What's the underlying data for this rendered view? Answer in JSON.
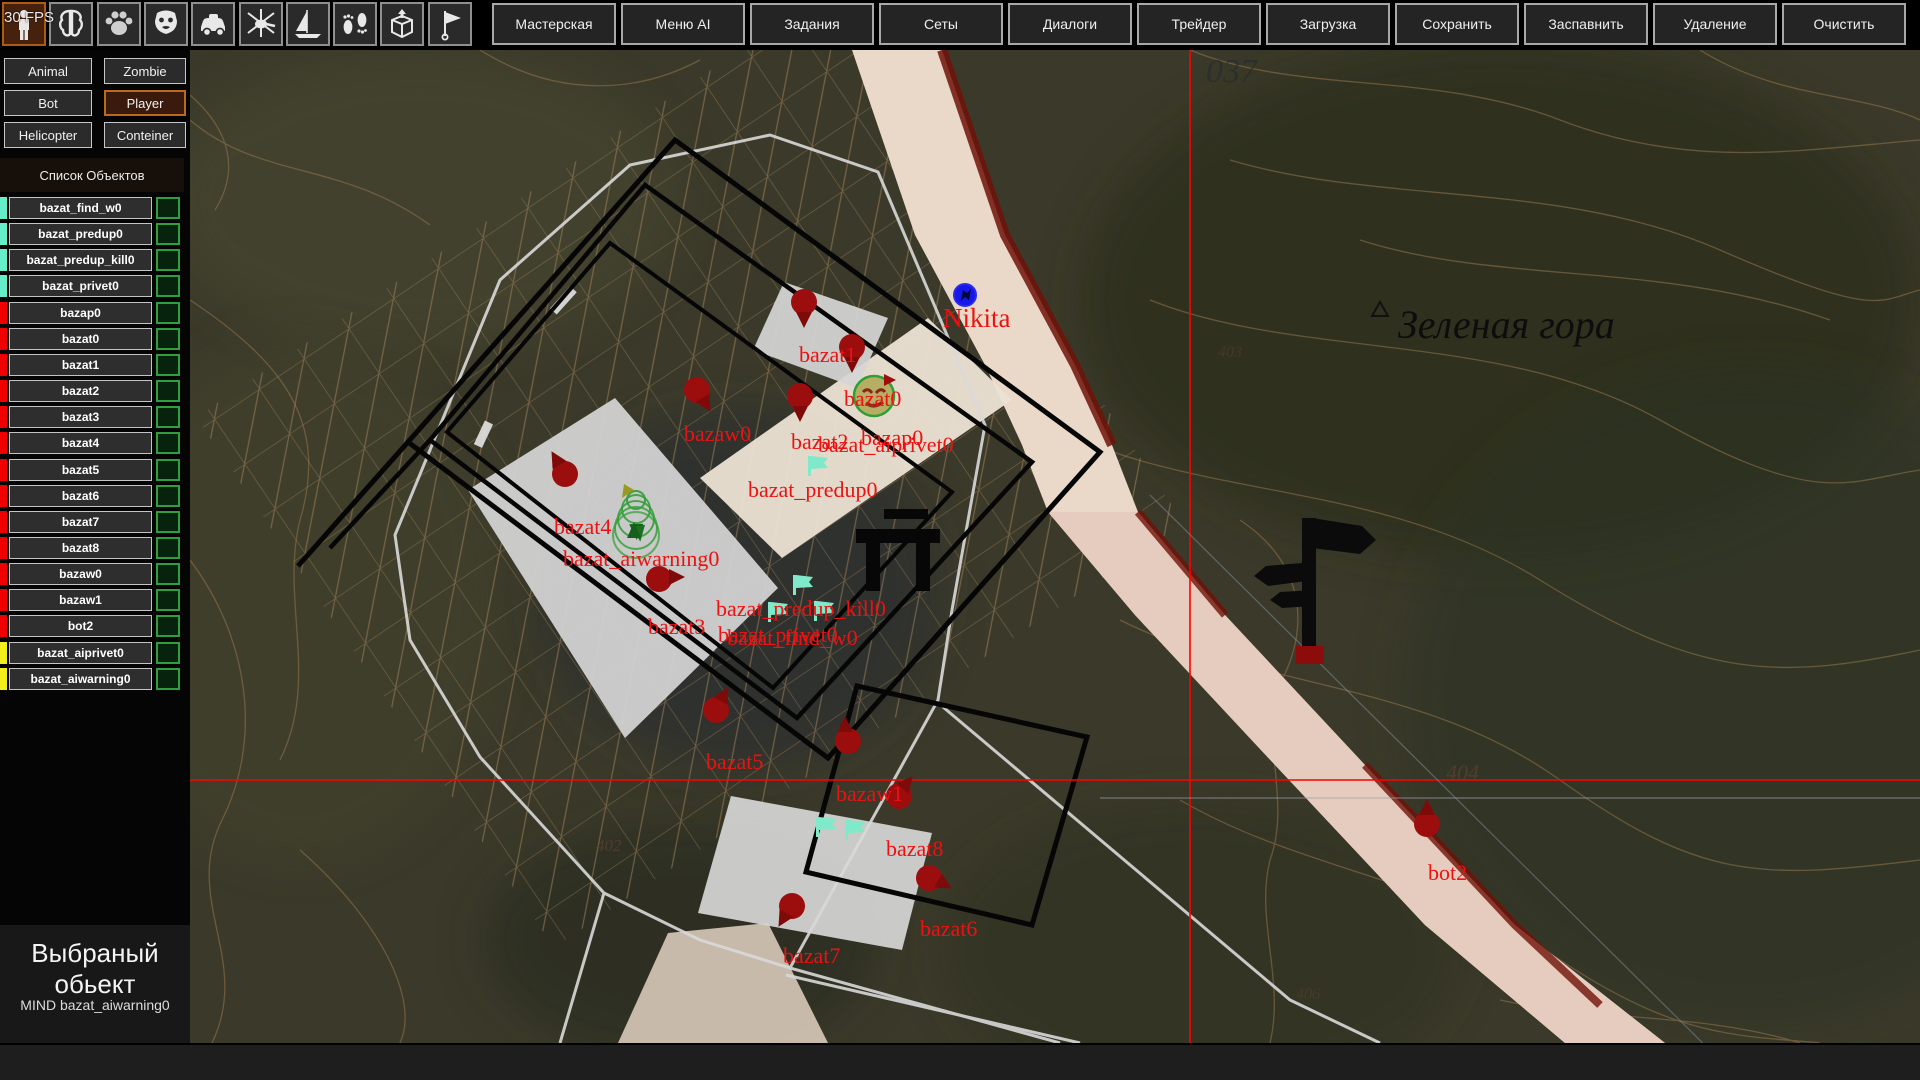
{
  "fps_label": "30 FPS",
  "toolbar": {
    "icons": [
      {
        "name": "person-icon",
        "selected": true
      },
      {
        "name": "brain-icon",
        "selected": false
      },
      {
        "name": "paw-icon",
        "selected": false
      },
      {
        "name": "zombie-icon",
        "selected": false
      },
      {
        "name": "car-icon",
        "selected": false
      },
      {
        "name": "helicopter-icon",
        "selected": false
      },
      {
        "name": "sailboat-icon",
        "selected": false
      },
      {
        "name": "footprints-icon",
        "selected": false
      },
      {
        "name": "crate-icon",
        "selected": false
      },
      {
        "name": "flag-icon",
        "selected": false
      }
    ],
    "buttons": [
      "Мастерская",
      "Меню AI",
      "Задания",
      "Сеты",
      "Диалоги",
      "Трейдер",
      "Загрузка",
      "Сохранить",
      "Заспавнить",
      "Удаление",
      "Очистить"
    ]
  },
  "sidebar": {
    "categories": [
      {
        "label": "Animal",
        "selected": false
      },
      {
        "label": "Zombie",
        "selected": false
      },
      {
        "label": "Bot",
        "selected": false
      },
      {
        "label": "Player",
        "selected": true
      },
      {
        "label": "Helicopter",
        "selected": false
      },
      {
        "label": "Conteiner",
        "selected": false
      }
    ],
    "list_header": "Список Объектов",
    "indicator_colors": {
      "cyan": "#66eec9",
      "red": "#ee0000",
      "yellow": "#f2ef1d"
    },
    "objects": [
      {
        "name": "bazat_find_w0",
        "indicator": "cyan"
      },
      {
        "name": "bazat_predup0",
        "indicator": "cyan"
      },
      {
        "name": "bazat_predup_kill0",
        "indicator": "cyan"
      },
      {
        "name": "bazat_privet0",
        "indicator": "cyan"
      },
      {
        "name": "bazap0",
        "indicator": "red"
      },
      {
        "name": "bazat0",
        "indicator": "red"
      },
      {
        "name": "bazat1",
        "indicator": "red"
      },
      {
        "name": "bazat2",
        "indicator": "red"
      },
      {
        "name": "bazat3",
        "indicator": "red"
      },
      {
        "name": "bazat4",
        "indicator": "red"
      },
      {
        "name": "bazat5",
        "indicator": "red"
      },
      {
        "name": "bazat6",
        "indicator": "red"
      },
      {
        "name": "bazat7",
        "indicator": "red"
      },
      {
        "name": "bazat8",
        "indicator": "red"
      },
      {
        "name": "bazaw0",
        "indicator": "red"
      },
      {
        "name": "bazaw1",
        "indicator": "red"
      },
      {
        "name": "bot2",
        "indicator": "red"
      },
      {
        "name": "bazat_aiprivet0",
        "indicator": "yellow"
      },
      {
        "name": "bazat_aiwarning0",
        "indicator": "yellow"
      }
    ]
  },
  "selected_panel": {
    "title": "Выбраный обьект",
    "value": "MIND bazat_aiwarning0"
  },
  "map": {
    "label_color": "#ee1111",
    "mountain_label": {
      "text": "Зеленая гора",
      "x": 1398,
      "y": 338,
      "size": 40
    },
    "grid_square_label": {
      "text": "037",
      "x": 1206,
      "y": 82
    },
    "contour_labels": [
      {
        "text": "404",
        "x": 1446,
        "y": 780,
        "size": 22,
        "o": 0.75
      },
      {
        "text": "402",
        "x": 596,
        "y": 851,
        "size": 17,
        "o": 0.7
      },
      {
        "text": "403",
        "x": 1218,
        "y": 357,
        "size": 16,
        "o": 0.5
      },
      {
        "text": "406",
        "x": 1296,
        "y": 999,
        "size": 16,
        "o": 0.5
      }
    ],
    "labels": [
      {
        "text": "Nikita",
        "x": 943,
        "y": 327,
        "size": 27
      },
      {
        "text": "bazat1",
        "x": 799,
        "y": 362,
        "size": 22
      },
      {
        "text": "bazat0",
        "x": 844,
        "y": 406,
        "size": 22
      },
      {
        "text": "bazaw0",
        "x": 684,
        "y": 441,
        "size": 22
      },
      {
        "text": "bazat2",
        "x": 791,
        "y": 449,
        "size": 22
      },
      {
        "text": "bazap0",
        "x": 861,
        "y": 445,
        "size": 22
      },
      {
        "text": "bazat_aiprivet0",
        "x": 818,
        "y": 452,
        "size": 22
      },
      {
        "text": "bazat_predup0",
        "x": 748,
        "y": 497,
        "size": 22
      },
      {
        "text": "bazat4",
        "x": 554,
        "y": 534,
        "size": 22
      },
      {
        "text": "bazat_aiwarning0",
        "x": 563,
        "y": 566,
        "size": 22
      },
      {
        "text": "bazat_predup_kill0",
        "x": 716,
        "y": 616,
        "size": 22
      },
      {
        "text": "bazat3",
        "x": 648,
        "y": 634,
        "size": 22
      },
      {
        "text": "bazat_privet0",
        "x": 718,
        "y": 642,
        "size": 22
      },
      {
        "text": "bazat_find_w0",
        "x": 727,
        "y": 645,
        "size": 22
      },
      {
        "text": "bazat5",
        "x": 706,
        "y": 769,
        "size": 22
      },
      {
        "text": "bazaw1",
        "x": 836,
        "y": 801,
        "size": 22
      },
      {
        "text": "bazat8",
        "x": 886,
        "y": 856,
        "size": 22
      },
      {
        "text": "bazat6",
        "x": 920,
        "y": 936,
        "size": 22
      },
      {
        "text": "bazat7",
        "x": 783,
        "y": 963,
        "size": 22
      },
      {
        "text": "bot2",
        "x": 1428,
        "y": 880,
        "size": 22
      }
    ],
    "markers": [
      {
        "x": 804,
        "y": 302,
        "tx": 804,
        "ty": 319,
        "tr": 180
      },
      {
        "x": 852,
        "y": 347,
        "tx": 852,
        "ty": 364,
        "tr": 180
      },
      {
        "x": 800,
        "y": 396,
        "tx": 800,
        "ty": 413,
        "tr": 180
      },
      {
        "x": 697,
        "y": 390,
        "tx": 706,
        "ty": 404,
        "tr": 150
      },
      {
        "x": 565,
        "y": 474,
        "tx": 556,
        "ty": 459,
        "tr": -30
      },
      {
        "x": 659,
        "y": 579,
        "tx": 676,
        "ty": 577,
        "tr": 90
      },
      {
        "x": 716,
        "y": 710,
        "tx": 724,
        "ty": 695,
        "tr": 30
      },
      {
        "x": 848,
        "y": 741,
        "tx": 845,
        "ty": 725,
        "tr": 0
      },
      {
        "x": 899,
        "y": 796,
        "tx": 907,
        "ty": 783,
        "tr": 40
      },
      {
        "x": 792,
        "y": 906,
        "tx": 783,
        "ty": 919,
        "tr": -150
      },
      {
        "x": 929,
        "y": 878,
        "tx": 944,
        "ty": 884,
        "tr": 120
      },
      {
        "x": 1427,
        "y": 824,
        "tx": 1427,
        "ty": 808,
        "tr": 0
      }
    ],
    "icons": [
      {
        "name": "flag-mint",
        "x": 808,
        "y": 456
      },
      {
        "name": "flag-mint",
        "x": 793,
        "y": 575
      },
      {
        "name": "flag-mint",
        "x": 768,
        "y": 602
      },
      {
        "name": "flag-mint",
        "x": 814,
        "y": 601
      },
      {
        "name": "flag-mint",
        "x": 816,
        "y": 817
      },
      {
        "name": "flag-mint",
        "x": 845,
        "y": 820
      },
      {
        "name": "zombie-face",
        "x": 874,
        "y": 396
      },
      {
        "name": "spiral",
        "x": 636,
        "y": 518
      },
      {
        "name": "signpost",
        "x": 1300,
        "y": 518
      },
      {
        "name": "table",
        "x": 856,
        "y": 509
      },
      {
        "name": "player-blue",
        "x": 965,
        "y": 295
      }
    ]
  }
}
